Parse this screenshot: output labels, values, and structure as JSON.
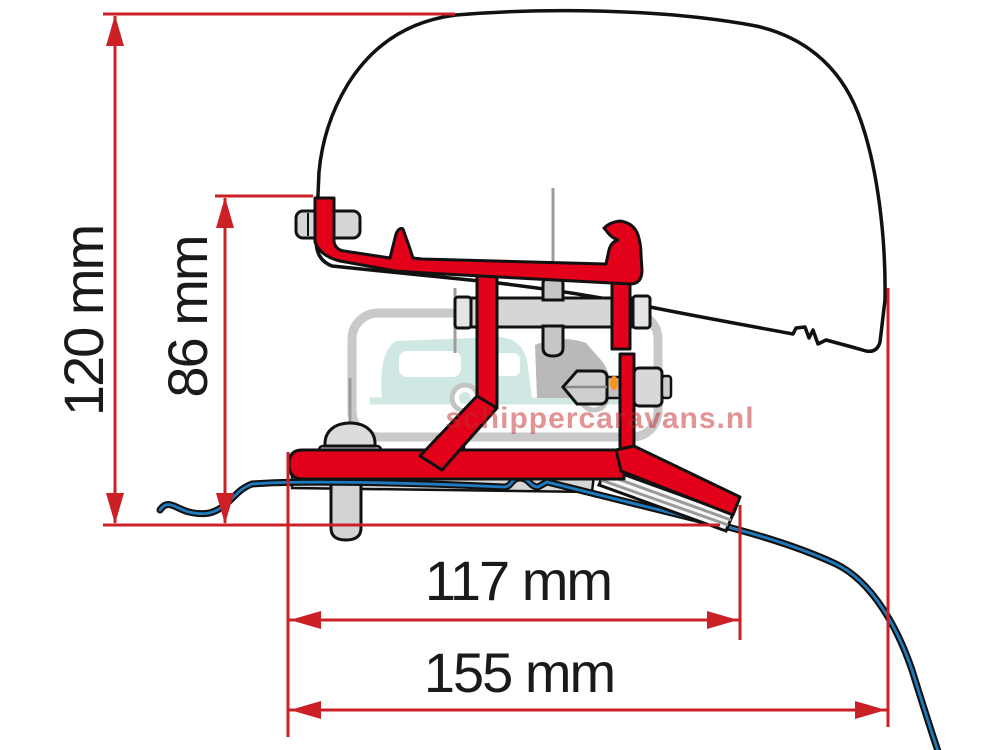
{
  "diagram": {
    "type": "awning roof adapter bracket side-profile dimension drawing",
    "dimensions": {
      "total_height": "120 mm",
      "bracket_height": "86 mm",
      "inner_width": "117 mm",
      "total_width": "155 mm"
    },
    "watermark_text": "schippercaravans.nl",
    "colors": {
      "dimension_red": "#cc2027",
      "bracket_red": "#e2001a",
      "roof_blue": "#1e7bc0",
      "hardware_gray": "#d6d6d6",
      "outline_black": "#111111",
      "watermark_teal": "#cfe8e4",
      "watermark_gray": "#c9c9c9",
      "watermark_red": "#c62a2b"
    }
  }
}
